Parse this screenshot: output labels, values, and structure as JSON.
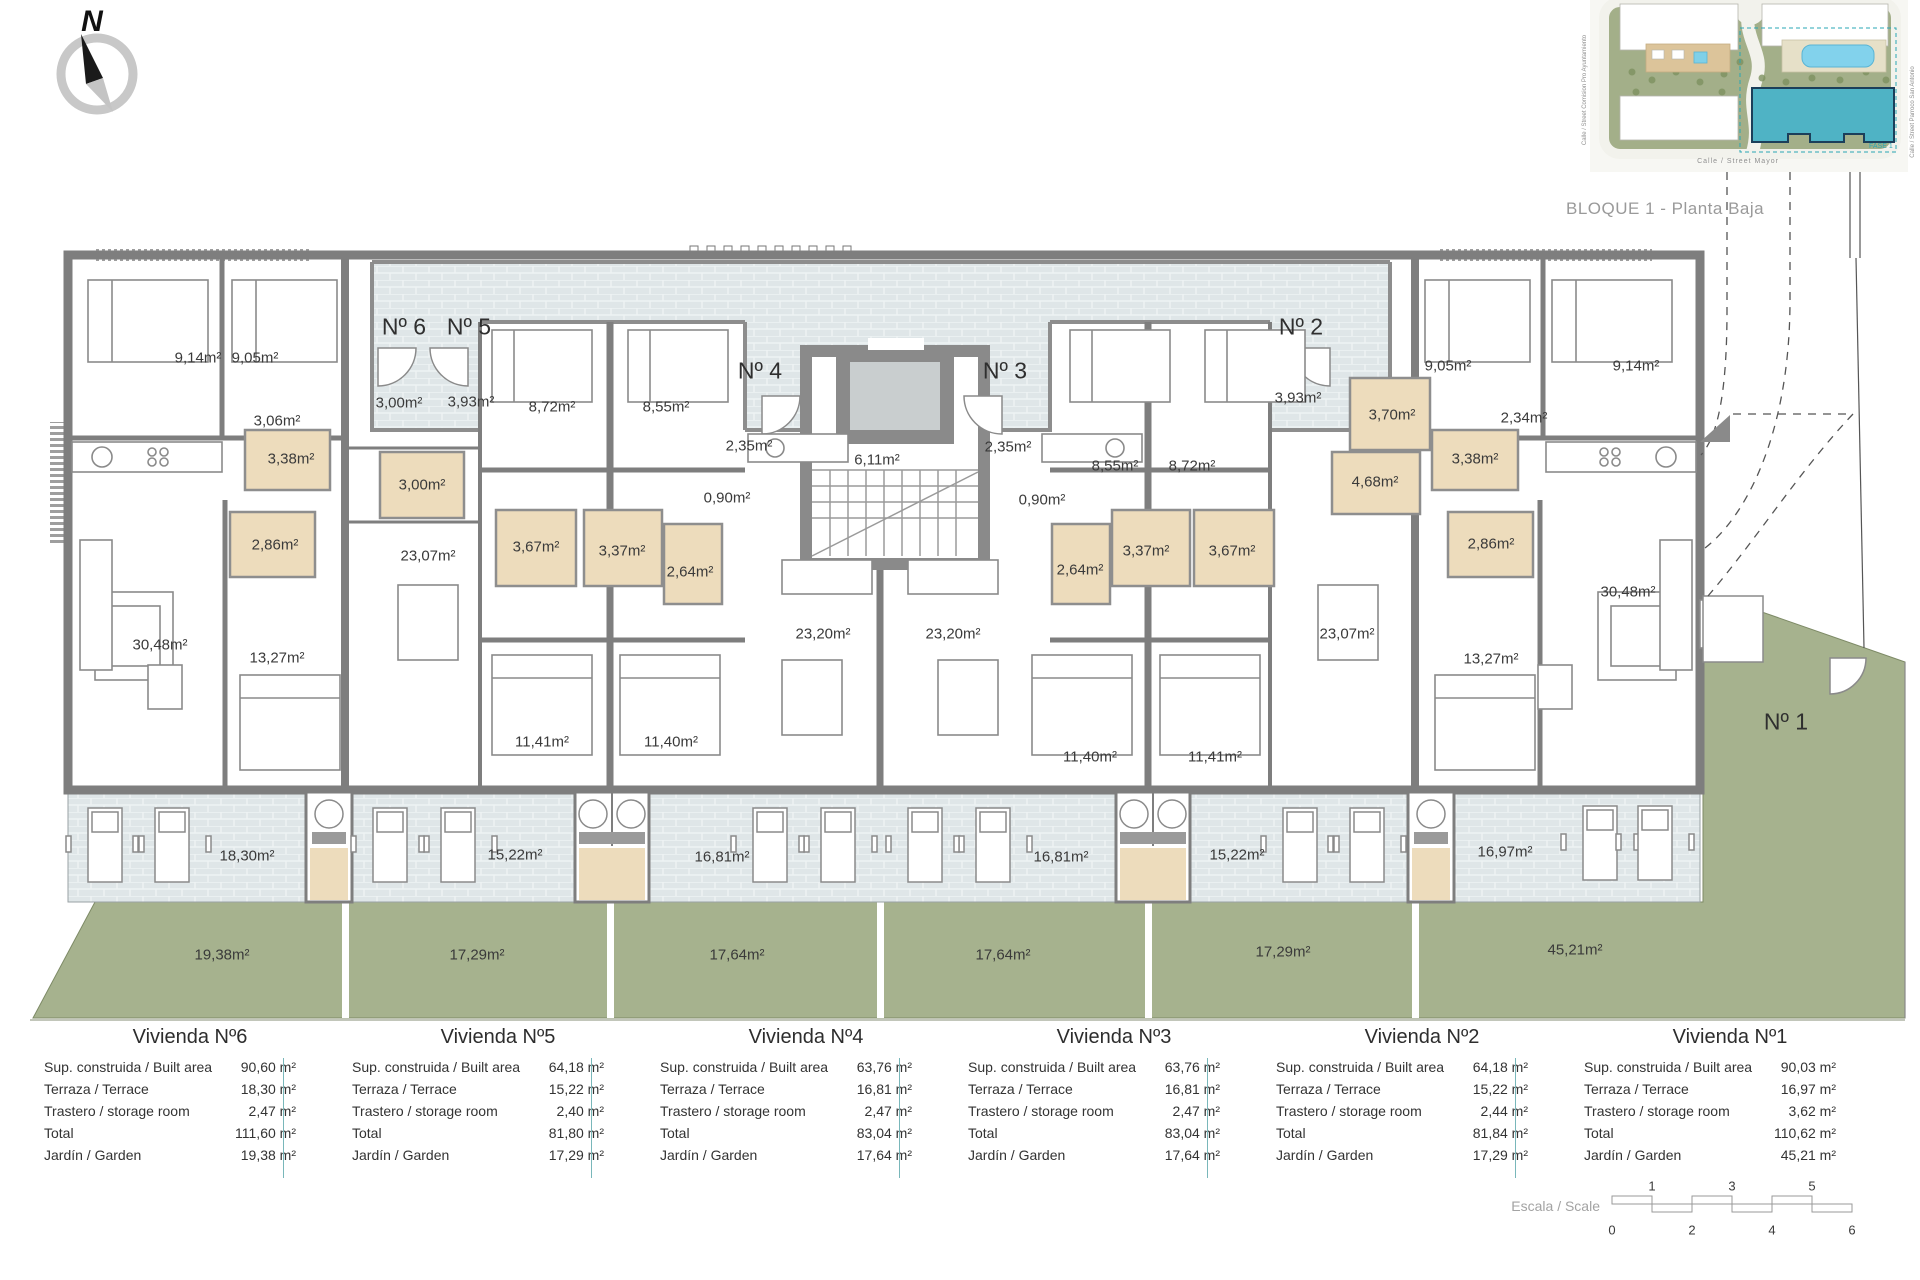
{
  "title": {
    "bloque": "BLOQUE 1 - Planta Baja"
  },
  "compass": {
    "north": "N"
  },
  "site_inset": {
    "street_left": "Calle / Street Comision Pro Ayuntamiento",
    "street_right": "Calle / Street Parroco San Antonio",
    "street_bottom": "Calle / Street Mayor",
    "fase": "FASE 1"
  },
  "colors": {
    "wall": "#7e7e7e",
    "terrace": "#dfe6e8",
    "garden": "#a6b28e",
    "bathroom_tan": "#eddcbc",
    "teal_accent": "#2aa7b5",
    "highlight_building": "#4fb3c5",
    "pool": "#82d2ec"
  },
  "plan": {
    "labels": [
      {
        "t": "Nº 6",
        "x": 404,
        "y": 327,
        "k": "entrance"
      },
      {
        "t": "Nº 5",
        "x": 469,
        "y": 327,
        "k": "entrance"
      },
      {
        "t": "Nº 4",
        "x": 760,
        "y": 371,
        "k": "entrance"
      },
      {
        "t": "Nº 3",
        "x": 1005,
        "y": 371,
        "k": "entrance"
      },
      {
        "t": "Nº 2",
        "x": 1301,
        "y": 327,
        "k": "entrance"
      },
      {
        "t": "Nº 1",
        "x": 1786,
        "y": 722,
        "k": "entrance"
      },
      {
        "t": "9,14m²",
        "x": 198,
        "y": 358,
        "k": "room"
      },
      {
        "t": "9,05m²",
        "x": 255,
        "y": 358,
        "k": "room"
      },
      {
        "t": "3,06m²",
        "x": 277,
        "y": 421,
        "k": "room"
      },
      {
        "t": "3,38m²",
        "x": 291,
        "y": 459,
        "k": "room"
      },
      {
        "t": "2,86m²",
        "x": 275,
        "y": 545,
        "k": "room"
      },
      {
        "t": "30,48m²",
        "x": 160,
        "y": 645,
        "k": "room"
      },
      {
        "t": "13,27m²",
        "x": 277,
        "y": 658,
        "k": "room"
      },
      {
        "t": "3,00m²",
        "x": 399,
        "y": 403,
        "k": "room"
      },
      {
        "t": "3,93m²",
        "x": 471,
        "y": 402,
        "k": "room"
      },
      {
        "t": "3,00m²",
        "x": 422,
        "y": 485,
        "k": "room"
      },
      {
        "t": "8,72m²",
        "x": 552,
        "y": 407,
        "k": "room"
      },
      {
        "t": "8,55m²",
        "x": 666,
        "y": 407,
        "k": "room"
      },
      {
        "t": "23,07m²",
        "x": 428,
        "y": 556,
        "k": "room"
      },
      {
        "t": "3,67m²",
        "x": 536,
        "y": 547,
        "k": "room"
      },
      {
        "t": "3,37m²",
        "x": 622,
        "y": 551,
        "k": "room"
      },
      {
        "t": "2,64m²",
        "x": 690,
        "y": 572,
        "k": "room"
      },
      {
        "t": "11,41m²",
        "x": 542,
        "y": 742,
        "k": "room"
      },
      {
        "t": "11,40m²",
        "x": 671,
        "y": 742,
        "k": "room"
      },
      {
        "t": "2,35m²",
        "x": 749,
        "y": 446,
        "k": "room"
      },
      {
        "t": "6,11m²",
        "x": 877,
        "y": 460,
        "k": "room"
      },
      {
        "t": "0,90m²",
        "x": 727,
        "y": 498,
        "k": "room"
      },
      {
        "t": "23,20m²",
        "x": 823,
        "y": 634,
        "k": "room"
      },
      {
        "t": "2,35m²",
        "x": 1008,
        "y": 447,
        "k": "room"
      },
      {
        "t": "0,90m²",
        "x": 1042,
        "y": 500,
        "k": "room"
      },
      {
        "t": "23,20m²",
        "x": 953,
        "y": 634,
        "k": "room"
      },
      {
        "t": "8,55m²",
        "x": 1115,
        "y": 466,
        "k": "room"
      },
      {
        "t": "8,72m²",
        "x": 1192,
        "y": 466,
        "k": "room"
      },
      {
        "t": "2,64m²",
        "x": 1080,
        "y": 570,
        "k": "room"
      },
      {
        "t": "3,37m²",
        "x": 1146,
        "y": 551,
        "k": "room"
      },
      {
        "t": "3,67m²",
        "x": 1232,
        "y": 551,
        "k": "room"
      },
      {
        "t": "11,40m²",
        "x": 1090,
        "y": 757,
        "k": "room"
      },
      {
        "t": "11,41m²",
        "x": 1215,
        "y": 757,
        "k": "room"
      },
      {
        "t": "3,93m²",
        "x": 1298,
        "y": 398,
        "k": "room"
      },
      {
        "t": "3,70m²",
        "x": 1392,
        "y": 415,
        "k": "room"
      },
      {
        "t": "4,68m²",
        "x": 1375,
        "y": 482,
        "k": "room"
      },
      {
        "t": "23,07m²",
        "x": 1347,
        "y": 634,
        "k": "room"
      },
      {
        "t": "13,27m²",
        "x": 1491,
        "y": 659,
        "k": "room"
      },
      {
        "t": "9,05m²",
        "x": 1448,
        "y": 366,
        "k": "room"
      },
      {
        "t": "9,14m²",
        "x": 1636,
        "y": 366,
        "k": "room"
      },
      {
        "t": "2,34m²",
        "x": 1524,
        "y": 418,
        "k": "room"
      },
      {
        "t": "3,38m²",
        "x": 1475,
        "y": 459,
        "k": "room"
      },
      {
        "t": "2,86m²",
        "x": 1491,
        "y": 544,
        "k": "room"
      },
      {
        "t": "30,48m²",
        "x": 1628,
        "y": 592,
        "k": "room"
      },
      {
        "t": "18,30m²",
        "x": 247,
        "y": 856,
        "k": "terrace"
      },
      {
        "t": "15,22m²",
        "x": 515,
        "y": 855,
        "k": "terrace"
      },
      {
        "t": "16,81m²",
        "x": 722,
        "y": 857,
        "k": "terrace"
      },
      {
        "t": "16,81m²",
        "x": 1061,
        "y": 857,
        "k": "terrace"
      },
      {
        "t": "15,22m²",
        "x": 1237,
        "y": 855,
        "k": "terrace"
      },
      {
        "t": "16,97m²",
        "x": 1505,
        "y": 852,
        "k": "terrace"
      },
      {
        "t": "19,38m²",
        "x": 222,
        "y": 955,
        "k": "garden"
      },
      {
        "t": "17,29m²",
        "x": 477,
        "y": 955,
        "k": "garden"
      },
      {
        "t": "17,64m²",
        "x": 737,
        "y": 955,
        "k": "garden"
      },
      {
        "t": "17,64m²",
        "x": 1003,
        "y": 955,
        "k": "garden"
      },
      {
        "t": "17,29m²",
        "x": 1283,
        "y": 952,
        "k": "garden"
      },
      {
        "t": "45,21m²",
        "x": 1575,
        "y": 950,
        "k": "garden"
      }
    ]
  },
  "table": {
    "row_labels": [
      "Sup. construida / Built area",
      "Terraza / Terrace",
      "Trastero / storage room",
      "Total",
      "Jardín / Garden"
    ],
    "columns": [
      {
        "title": "Vivienda Nº6",
        "values": [
          "90,60 m²",
          "18,30 m²",
          "2,47 m²",
          "111,60 m²",
          "19,38 m²"
        ]
      },
      {
        "title": "Vivienda Nº5",
        "values": [
          "64,18 m²",
          "15,22 m²",
          "2,40 m²",
          "81,80 m²",
          "17,29 m²"
        ]
      },
      {
        "title": "Vivienda Nº4",
        "values": [
          "63,76 m²",
          "16,81 m²",
          "2,47 m²",
          "83,04 m²",
          "17,64 m²"
        ]
      },
      {
        "title": "Vivienda Nº3",
        "values": [
          "63,76 m²",
          "16,81 m²",
          "2,47 m²",
          "83,04 m²",
          "17,64 m²"
        ]
      },
      {
        "title": "Vivienda Nº2",
        "values": [
          "64,18 m²",
          "15,22 m²",
          "2,44 m²",
          "81,84 m²",
          "17,29 m²"
        ]
      },
      {
        "title": "Vivienda Nº1",
        "values": [
          "90,03 m²",
          "16,97 m²",
          "3,62 m²",
          "110,62 m²",
          "45,21 m²"
        ]
      }
    ]
  },
  "scale": {
    "label": "Escala / Scale",
    "top_numbers": [
      "1",
      "3",
      "5"
    ],
    "bottom_numbers": [
      "0",
      "2",
      "4",
      "6"
    ]
  }
}
